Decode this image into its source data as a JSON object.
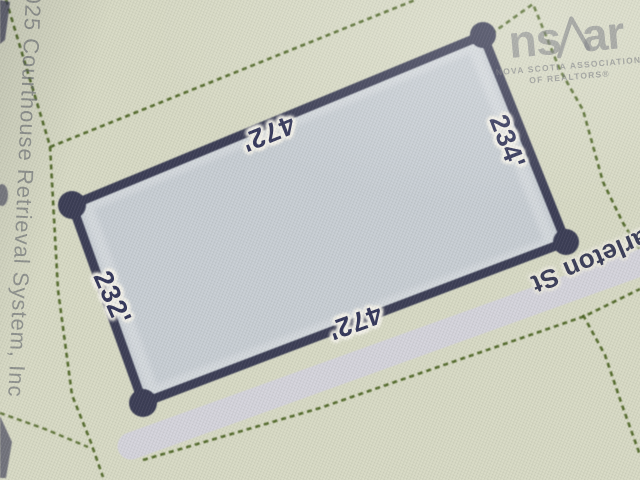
{
  "map": {
    "parcel": {
      "dim_top": "472'",
      "dim_right": "234'",
      "dim_bottom": "472'",
      "dim_left": "232'"
    },
    "street": {
      "label": "arleton St"
    },
    "watermark": {
      "logo_prefix": "ns",
      "logo_suffix": "ar",
      "caption_line1": "NOVA SCOTIA ASSOCIATION",
      "caption_line2": "OF REALTORS®"
    },
    "copyright": "025 Courthouse Retrieval System, Inc"
  },
  "colors": {
    "background": "#d8dac5",
    "parcel_fill": "#c7cdd5",
    "parcel_outline": "#3a3c55",
    "boundary_green": "#47601f",
    "road_gray": "#d5d4de",
    "label_navy": "#33365a",
    "watermark_gray": "#85878c"
  }
}
